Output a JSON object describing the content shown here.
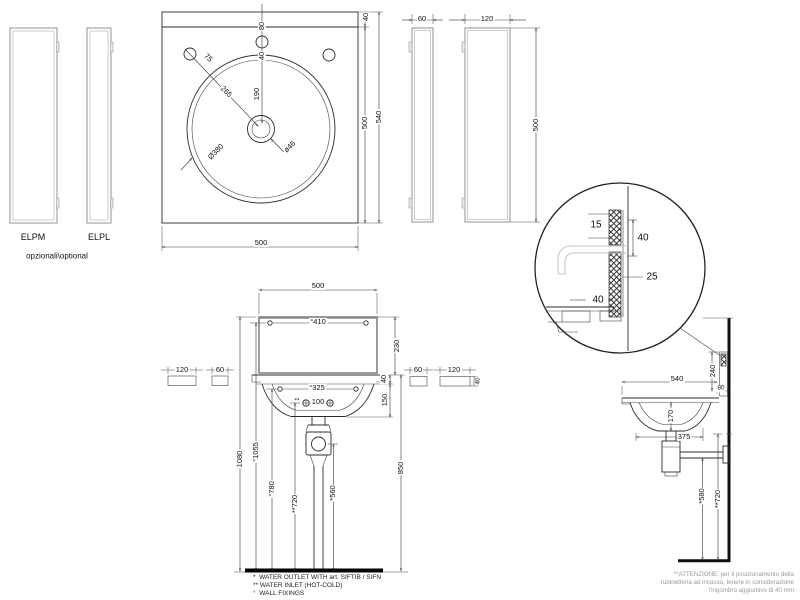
{
  "views": {
    "optional_panels_front": {
      "elpm_label": "ELPM",
      "elpl_label": "ELPL",
      "caption": "opzionali\\optional"
    },
    "top_view": {
      "dim_80": "80",
      "dim_40_hole": "40",
      "dim_190": "190",
      "dim_75": "75",
      "dim_265": "265",
      "dim_basin_diameter": "Ø380",
      "dim_drain_diameter": "ø46",
      "dim_40_ledge": "40",
      "dim_500_depth": "500",
      "dim_540_total": "540",
      "dim_500_width": "500"
    },
    "optional_panels_side": {
      "dim_60": "60",
      "dim_120": "120",
      "dim_500": "500"
    },
    "detail_view": {
      "dim_15": "15",
      "dim_40_upper": "40",
      "dim_25": "25",
      "dim_40_lower": "40"
    },
    "front_view": {
      "dim_500": "500",
      "dim_410": "°410",
      "dim_230": "230",
      "dim_325": "°325",
      "dim_100_prefix": "**",
      "dim_100": "100",
      "dim_40_rim": "40",
      "dim_150": "150",
      "dim_850": "850",
      "dim_1080": "1080",
      "dim_1055": "°1055",
      "dim_780": "°780",
      "dim_720": "**720",
      "dim_560": "*560",
      "left_panel_120": "120",
      "left_panel_60": "60",
      "right_panel_60": "60",
      "right_panel_120": "120",
      "right_panel_40": "40"
    },
    "side_view": {
      "dim_540": "540",
      "dim_80": "80",
      "dim_240": "240",
      "dim_170": "170",
      "dim_375": "375",
      "dim_580": "*580",
      "dim_720": "**720"
    }
  },
  "notes": {
    "footnotes": [
      "*  WATER OUTLET WITH art. SIFTIB / SIFN",
      "** WATER INLET (HOT-COLD)",
      "°  WALL FIXINGS"
    ],
    "attention": [
      "**ATTENZIONE: per il posizionamento della",
      "rubinetteria ad incasso, tenere in considerazione",
      "l'ingombro aggiuntivo di 40 mm"
    ]
  }
}
